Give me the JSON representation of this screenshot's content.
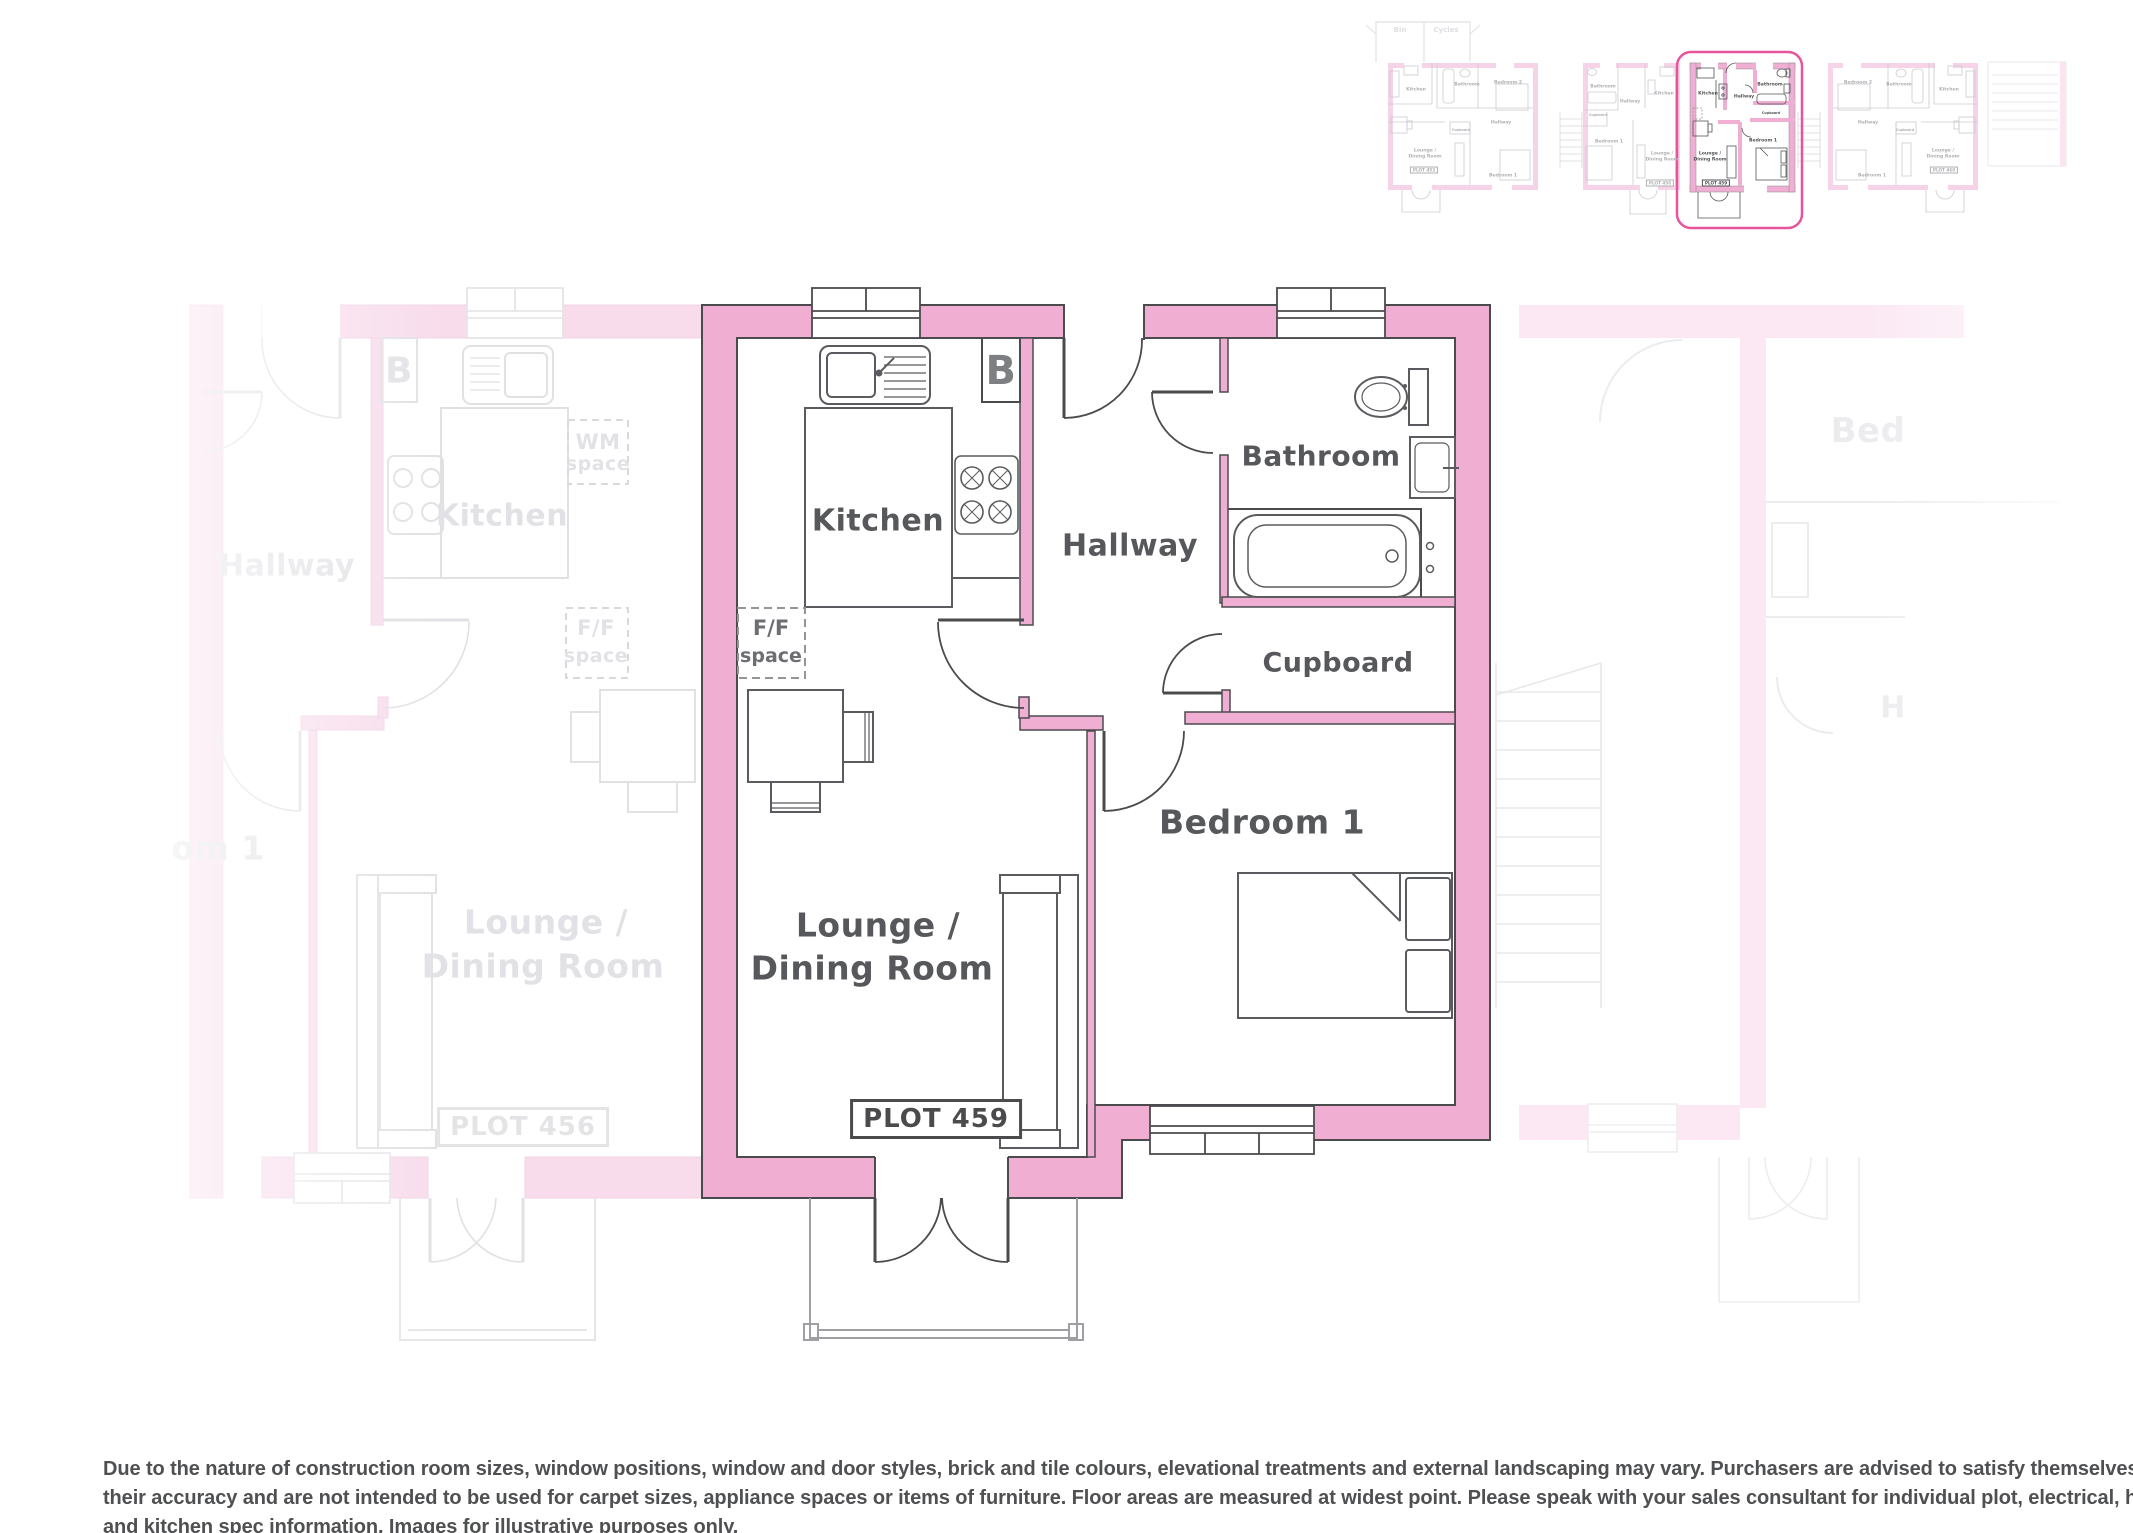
{
  "main_plan": {
    "plot_label": "PLOT 459",
    "rooms": {
      "kitchen": "Kitchen",
      "hallway": "Hallway",
      "bathroom": "Bathroom",
      "cupboard": "Cupboard",
      "bedroom": "Bedroom 1",
      "lounge_line1": "Lounge /",
      "lounge_line2": "Dining Room"
    },
    "annotations": {
      "boiler": "B",
      "fridge_line1": "F/F",
      "fridge_line2": "space"
    }
  },
  "neighbour_left_plan": {
    "plot_label": "PLOT 456",
    "labels": {
      "kitchen": "Kitchen",
      "hallway": "Hallway",
      "bedroom_partial": "om 1",
      "lounge_line1": "Lounge /",
      "lounge_line2": "Dining Room",
      "boiler": "B",
      "wm_line1": "WM",
      "wm_line2": "space",
      "fridge_line1": "F/F",
      "fridge_line2": "space"
    }
  },
  "neighbour_right_plan": {
    "labels": {
      "bedroom_partial": "Bed",
      "hallway_partial": "H"
    }
  },
  "site_strip": {
    "bin_store": {
      "bin": "Bin",
      "cycles": "Cycles"
    },
    "highlight_color": "#E8549B",
    "thumbnails": [
      {
        "plot": "thumb-453",
        "highlighted": false,
        "labels": [
          {
            "t": "Kitchen",
            "x": 1416,
            "y": 90
          },
          {
            "t": "Bathroom",
            "x": 1467,
            "y": 85
          },
          {
            "t": "Bedroom 2",
            "x": 1508,
            "y": 83
          },
          {
            "t": "Hallway",
            "x": 1501,
            "y": 123
          },
          {
            "t": "Cupboard",
            "x": 1461,
            "y": 130,
            "s": 3.4
          },
          {
            "t": "Lounge /",
            "x": 1425,
            "y": 151
          },
          {
            "t": "Dining Room",
            "x": 1425,
            "y": 157
          },
          {
            "t": "Bedroom 1",
            "x": 1503,
            "y": 176
          },
          {
            "t": "PLOT 453",
            "x": 1424,
            "y": 170,
            "box": true
          }
        ]
      },
      {
        "plot": "thumb-456",
        "highlighted": false,
        "labels": [
          {
            "t": "Bathroom",
            "x": 1603,
            "y": 87
          },
          {
            "t": "Hallway",
            "x": 1630,
            "y": 102
          },
          {
            "t": "Kitchen",
            "x": 1664,
            "y": 94
          },
          {
            "t": "Cupboard",
            "x": 1598,
            "y": 115,
            "s": 3.4
          },
          {
            "t": "Bedroom 1",
            "x": 1609,
            "y": 142
          },
          {
            "t": "Lounge /",
            "x": 1662,
            "y": 154
          },
          {
            "t": "Dining Room",
            "x": 1662,
            "y": 160
          },
          {
            "t": "PLOT 456",
            "x": 1660,
            "y": 183,
            "box": true
          }
        ]
      },
      {
        "plot": "thumb-459",
        "highlighted": true,
        "labels": [
          {
            "t": "Kitchen",
            "x": 1708,
            "y": 94
          },
          {
            "t": "Hallway",
            "x": 1744,
            "y": 97
          },
          {
            "t": "Bathroom",
            "x": 1770,
            "y": 85
          },
          {
            "t": "Cupboard",
            "x": 1771,
            "y": 113,
            "s": 3.4
          },
          {
            "t": "Bedroom 1",
            "x": 1763,
            "y": 141
          },
          {
            "t": "Lounge /",
            "x": 1710,
            "y": 154
          },
          {
            "t": "Dining Room",
            "x": 1710,
            "y": 160
          },
          {
            "t": "PLOT 459",
            "x": 1716,
            "y": 183,
            "box": true
          }
        ]
      },
      {
        "plot": "thumb-460",
        "highlighted": false,
        "labels": [
          {
            "t": "Bedroom 2",
            "x": 1858,
            "y": 83
          },
          {
            "t": "Bathroom",
            "x": 1899,
            "y": 85
          },
          {
            "t": "Kitchen",
            "x": 1949,
            "y": 90
          },
          {
            "t": "Hallway",
            "x": 1868,
            "y": 123
          },
          {
            "t": "Cupboard",
            "x": 1905,
            "y": 130,
            "s": 3.4
          },
          {
            "t": "Bedroom 1",
            "x": 1872,
            "y": 176
          },
          {
            "t": "Lounge /",
            "x": 1943,
            "y": 151
          },
          {
            "t": "Dining Room",
            "x": 1943,
            "y": 157
          },
          {
            "t": "PLOT 460",
            "x": 1944,
            "y": 170,
            "box": true
          }
        ]
      }
    ]
  },
  "disclaimer": {
    "line1": "Due to the nature of construction room sizes, window positions, window and door styles, brick and tile colours, elevational treatments and external landscaping may vary. Purchasers are advised to satisfy themselves as to",
    "line2": "their accuracy and are not intended to be used for carpet sizes, appliance spaces or items of furniture. Floor areas are measured at widest point. Please speak with your sales consultant for individual plot, electrical, heating",
    "line3": "and kitchen spec information. Images for illustrative purposes only."
  },
  "colors": {
    "wall_pink": "#F1AED3",
    "wall_outline": "#4B4B4E",
    "label_gray": "#57585B",
    "highlight_ring": "#E8549B",
    "porch_gray": "#9FA0A3"
  }
}
